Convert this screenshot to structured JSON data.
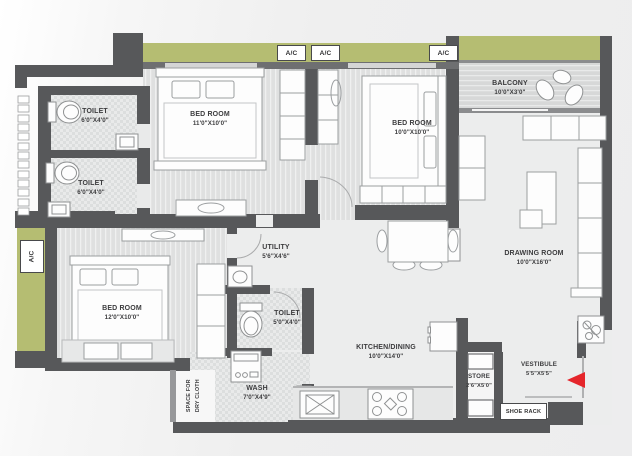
{
  "rooms": {
    "toilet1": {
      "name": "TOILET",
      "dims": "6'0\"X4'0\""
    },
    "toilet2": {
      "name": "TOILET",
      "dims": "6'0\"X4'0\""
    },
    "bedroom1": {
      "name": "BED ROOM",
      "dims": "11'0\"X10'0\""
    },
    "bedroom2": {
      "name": "BED ROOM",
      "dims": "10'0\"X10'0\""
    },
    "bedroom3": {
      "name": "BED ROOM",
      "dims": "12'0\"X10'0\""
    },
    "balcony": {
      "name": "BALCONY",
      "dims": "10'0\"X3'0\""
    },
    "drawing": {
      "name": "DRAWING ROOM",
      "dims": "10'0\"X16'0\""
    },
    "kitchen": {
      "name": "KITCHEN/DINING",
      "dims": "10'0\"X14'0\""
    },
    "utility": {
      "name": "UTILITY",
      "dims": "5'6\"X4'6\""
    },
    "toilet3": {
      "name": "TOILET",
      "dims": "5'0\"X4'0\""
    },
    "wash": {
      "name": "WASH",
      "dims": "7'0\"X4'9\""
    },
    "store": {
      "name": "STORE",
      "dims": "2'6\"X5'0\""
    },
    "vestibule": {
      "name": "VESTIBULE",
      "dims": "5'5\"X5'5\""
    }
  },
  "fixtures": {
    "ac": "A/C",
    "shoe_rack": "SHOE RACK",
    "dry_l1": "SPACE FOR",
    "dry_l2": "DRY CLOTH"
  },
  "colors": {
    "wall": "#57585a",
    "ledge_olive": "#b5bd72",
    "floor": "#eceded",
    "entry_arrow": "#e5262b"
  }
}
